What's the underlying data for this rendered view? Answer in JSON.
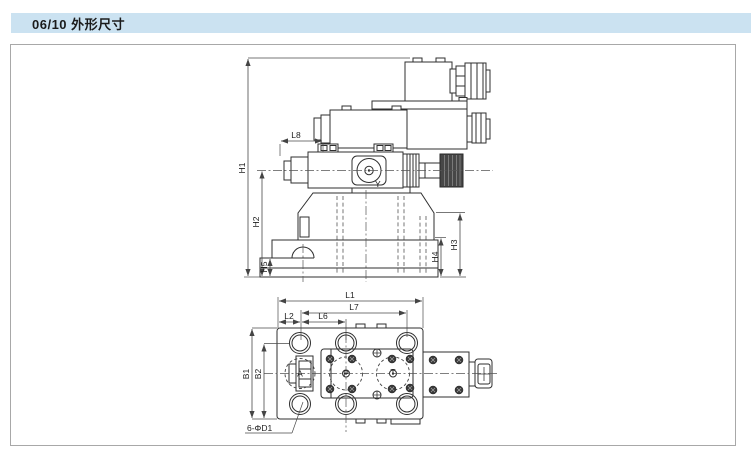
{
  "header": {
    "title": "06/10 外形尺寸"
  },
  "colors": {
    "header_bg": "#cbe2f1",
    "header_text": "#1b1b1b",
    "panel_border": "#a8a8a8",
    "drawing_line": "#2f2f2f",
    "dimension_line": "#4a4a4a",
    "knob_fill": "#474747"
  },
  "side_view": {
    "dims": {
      "h1": "H1",
      "h2": "H2",
      "h5": "H5",
      "h3": "H3",
      "h4": "H4",
      "l8": "L8"
    },
    "port_y": "Y"
  },
  "top_view": {
    "dims": {
      "l1": "L1",
      "l7": "L7",
      "l2": "L2",
      "l6": "L6",
      "b1": "B1",
      "b2": "B2"
    },
    "ports": {
      "a": "A",
      "p": "P",
      "t": "T"
    },
    "hole_note": "6-ΦD1"
  }
}
